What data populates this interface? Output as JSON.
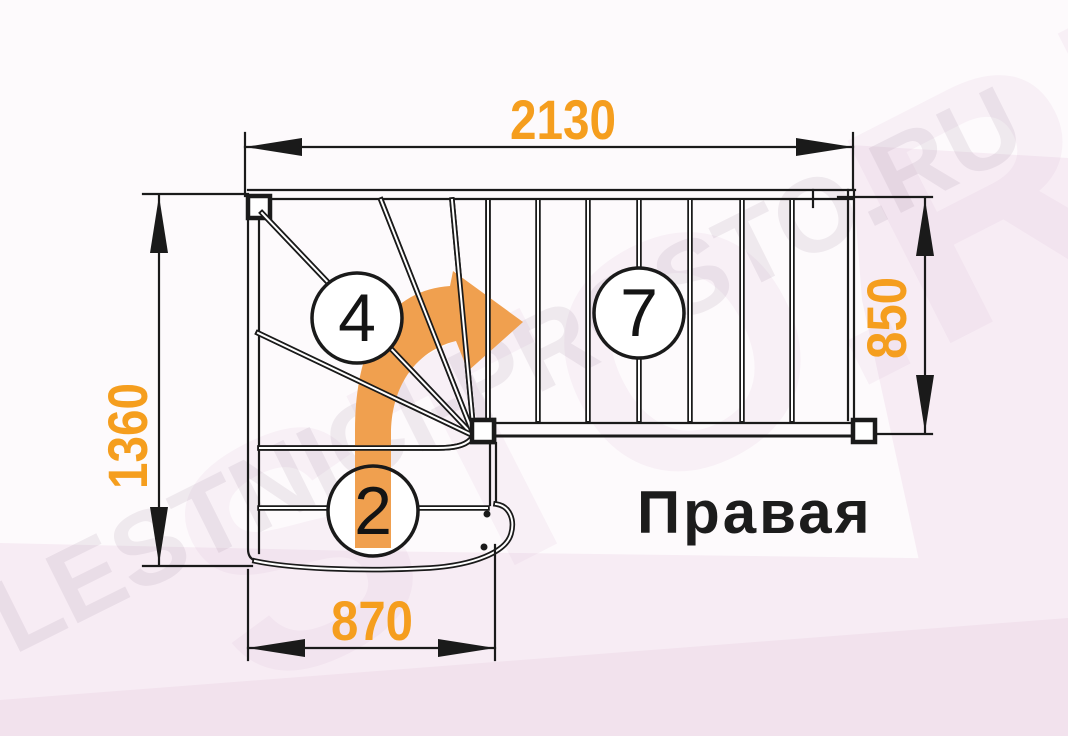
{
  "title": "Правая",
  "watermark": "LESTNICI-PROSTO.RU",
  "watermark_fragment": "STO.RU",
  "dimensions": {
    "top": "2130",
    "left": "1360",
    "right": "850",
    "bottom": "870"
  },
  "steps": {
    "winder": "4",
    "upper_flight": "7",
    "lower_flight": "2"
  },
  "colors": {
    "accent": "#F59E1E",
    "arrow": "#F0A04F",
    "line": "#1A1A1A",
    "bg": "#FDFAFC",
    "bg_pink": "#F7ECF4",
    "bg_pink_dark": "#F2E2ED"
  }
}
